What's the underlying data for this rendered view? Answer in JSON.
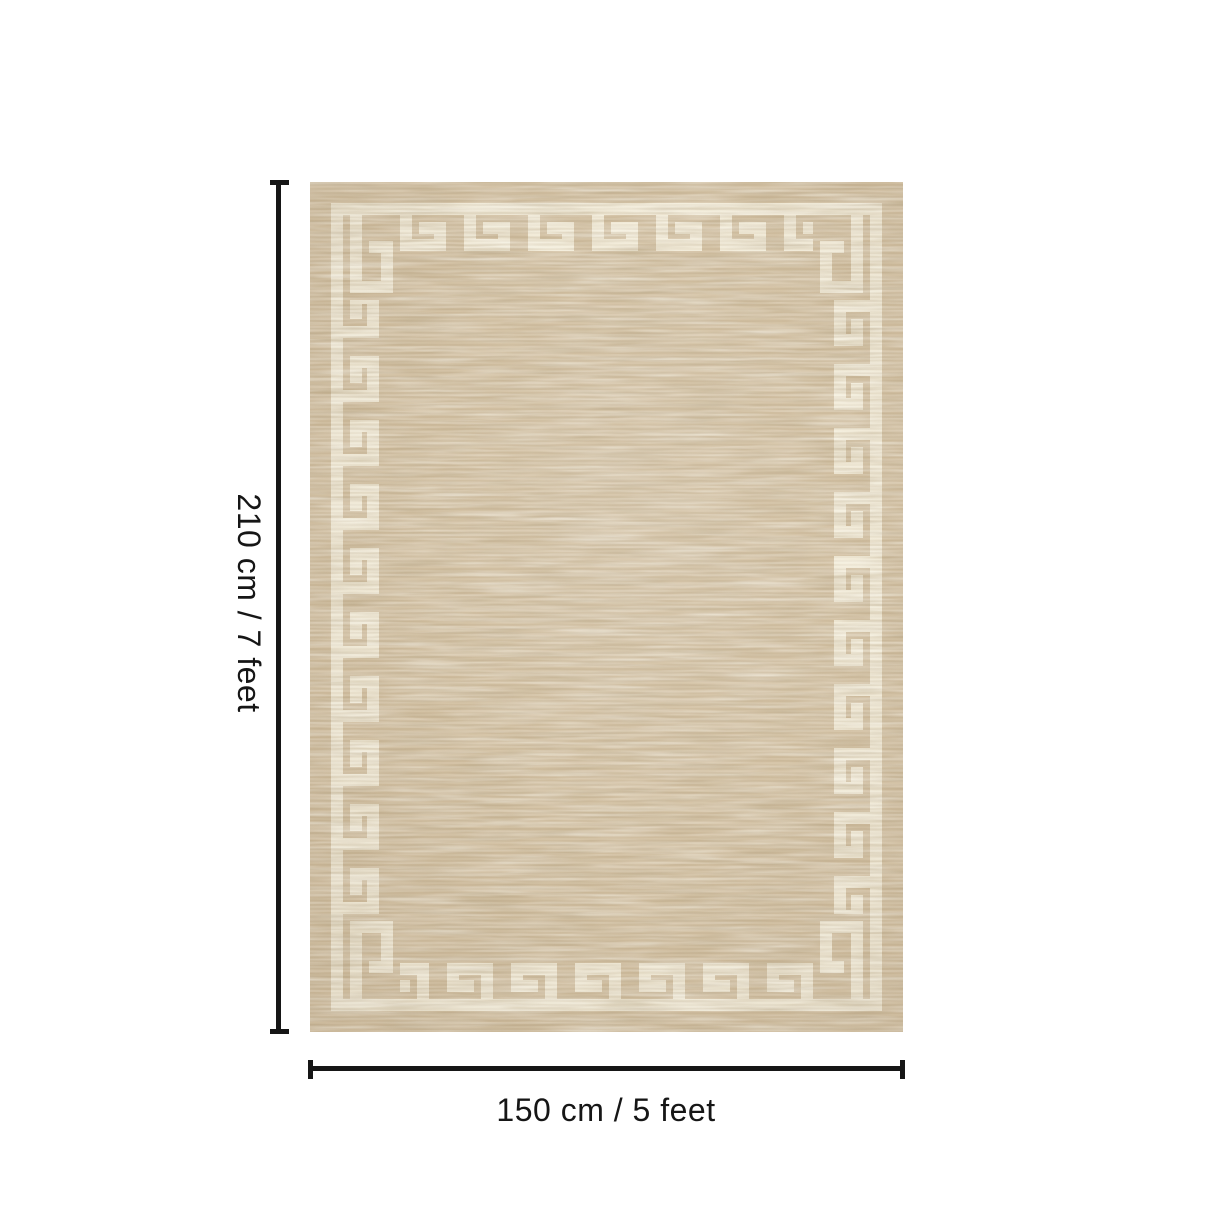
{
  "page": {
    "background_color": "#ffffff"
  },
  "product_diagram": {
    "item": "rug",
    "pattern": "greek-key-border",
    "colors": {
      "rug_base": "#d3c1a3",
      "pattern_cream": "#f2ebd8",
      "annotation_ink": "#161616"
    }
  },
  "dimension_annotations": {
    "vertical": {
      "label": "210 cm / 7 feet",
      "cm": 210,
      "feet": 7
    },
    "horizontal": {
      "label": "150 cm / 5 feet",
      "cm": 150,
      "feet": 5
    }
  }
}
